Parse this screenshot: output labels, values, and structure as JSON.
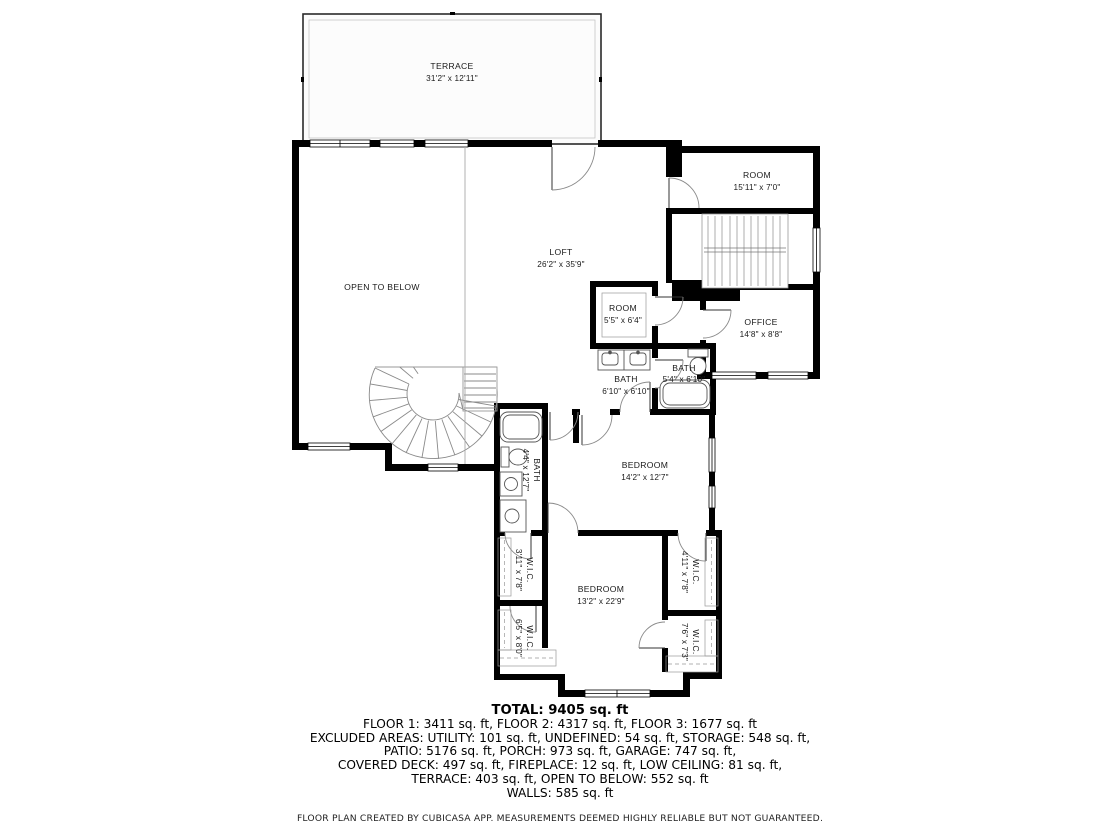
{
  "rooms": {
    "terrace": {
      "name": "TERRACE",
      "dims": "31'2\" x 12'11\""
    },
    "room_top": {
      "name": "ROOM",
      "dims": "15'11\" x 7'0\""
    },
    "loft": {
      "name": "LOFT",
      "dims": "26'2\" x 35'9\""
    },
    "open_to_below": {
      "name": "OPEN TO BELOW"
    },
    "room_small": {
      "name": "ROOM",
      "dims": "5'5\" x 6'4\""
    },
    "office": {
      "name": "OFFICE",
      "dims": "14'8\" x 8'8\""
    },
    "bath_left": {
      "name": "BATH",
      "dims": "6'10\" x 6'10\""
    },
    "bath_right": {
      "name": "BATH",
      "dims": "5'4\" x 6'10\""
    },
    "bath_vertical": {
      "name": "BATH",
      "dims": "4'4\" x 12'7\""
    },
    "bedroom_upper": {
      "name": "BEDROOM",
      "dims": "14'2\" x 12'7\""
    },
    "bedroom_lower": {
      "name": "BEDROOM",
      "dims": "13'2\" x 22'9\""
    },
    "wic_left_top": {
      "name": "W.I.C.",
      "dims": "3'11\" x 7'8\""
    },
    "wic_right_top": {
      "name": "W.I.C.",
      "dims": "4'11\" x 7'8\""
    },
    "wic_left_bottom": {
      "name": "W.I.C.",
      "dims": "6'5\" x 8'0\""
    },
    "wic_right_bottom": {
      "name": "W.I.C.",
      "dims": "7'6\" x 7'3\""
    }
  },
  "summary": {
    "total": "TOTAL: 9405 sq. ft",
    "line1": "FLOOR 1: 3411 sq. ft, FLOOR 2: 4317 sq. ft, FLOOR 3: 1677 sq. ft",
    "line2": "EXCLUDED AREAS: UTILITY: 101 sq. ft, UNDEFINED: 54 sq. ft, STORAGE: 548 sq. ft,",
    "line3": "PATIO: 5176 sq. ft, PORCH: 973 sq. ft, GARAGE: 747 sq. ft,",
    "line4": "COVERED DECK: 497 sq. ft, FIREPLACE: 12 sq. ft, LOW CEILING: 81 sq. ft,",
    "line5": "TERRACE: 403 sq. ft, OPEN TO BELOW: 552 sq. ft",
    "line6": "WALLS: 585 sq. ft"
  },
  "footer": "FLOOR PLAN CREATED BY CUBICASA APP. MEASUREMENTS DEEMED HIGHLY RELIABLE BUT NOT GUARANTEED.",
  "colors": {
    "wall": "#000000",
    "thin_line": "#999999",
    "text": "#1a1a1a"
  }
}
